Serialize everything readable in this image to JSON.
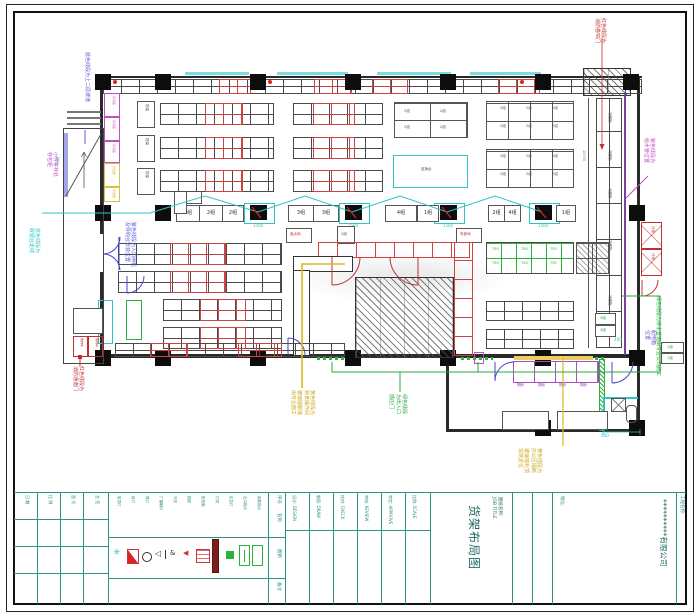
{
  "sheet": {
    "company": "**********有限公司",
    "project_label": "工程名称:",
    "address_label": "地址:",
    "drawing_name_label": "图纸名称:",
    "drawing_name_en": "JOB TITLE",
    "drawing_title": "货架布局图"
  },
  "title_fields": {
    "f1": "设计: DESIGN",
    "f2": "制图: DRAW",
    "f3": "校对: CHECK",
    "f4": "审核: REVIEW",
    "f5": "审定: APPROVE",
    "f6": "比例: SCALE"
  },
  "left_fields": {
    "f1": "日 期",
    "f2": "比 例",
    "f3": "图 号",
    "f4": "会 签"
  },
  "legend": {
    "headers": {
      "index": "序号",
      "name": "名称",
      "symbol": "图例",
      "note": "备注"
    },
    "names": {
      "n1": "吸顶灯",
      "n2": "射灯",
      "n3": "筒灯",
      "n4": "广播喇叭",
      "n5": "开关",
      "n6": "插座",
      "n7": "配电箱",
      "n8": "灯带",
      "n9": "应急灯",
      "n10": "出口指示",
      "n11": "疏散指示"
    }
  },
  "annotations": {
    "blue_tl": {
      "text": "蓝色线段为上二层坡道"
    },
    "mag_l": {
      "text": "小件寄存处\n存包柜"
    },
    "cyan_l": {
      "text": "蓝色线段为\n收银台走线"
    },
    "purple_l": {
      "text": "紫色线段为入口闸机\n及导购台安装位置"
    },
    "red_bl": {
      "text": "红色线段为\n消防通道门"
    },
    "yellow_bm": {
      "text": "黄色线段为\n熟食操作间\n玻璃隔断墙\n由专业施工"
    },
    "green_bm": {
      "text": "绿色线段\n为出入口\n感应门"
    },
    "yellow_br": {
      "text": "黄色线段为\n办公区隔断\n玻璃墙到顶\n现场定位"
    },
    "green_br": {
      "text": "绿色线段为排水管道由专业公司施工"
    },
    "red_tr": {
      "text": "红色线段为\n消防卷帘门"
    },
    "mag_r": {
      "text": "紫色线段为\n给水管位置"
    },
    "blue_br": {
      "text": "配电箱\n位置"
    }
  },
  "lanes": {
    "a": "2组",
    "b": "2组",
    "c": "2组",
    "d": "3组",
    "e": "3组",
    "f": "4组",
    "g": "1组",
    "h": "2组",
    "i": "4组",
    "j": "1组",
    "k": "3组",
    "l": "4组"
  },
  "micro": {
    "cell": "2组",
    "size": "750",
    "shelf": "货架",
    "counter": "冷藏柜",
    "cold": "冷柜",
    "locker": "存包柜",
    "fresh": "促销台",
    "dept": "面点间",
    "dept2": "熟食间",
    "fix": "隔断",
    "cart": "购物车"
  },
  "dims": {
    "d1": "1500",
    "d2": "200",
    "d3": "500",
    "d4": "400",
    "d5": "15750"
  }
}
